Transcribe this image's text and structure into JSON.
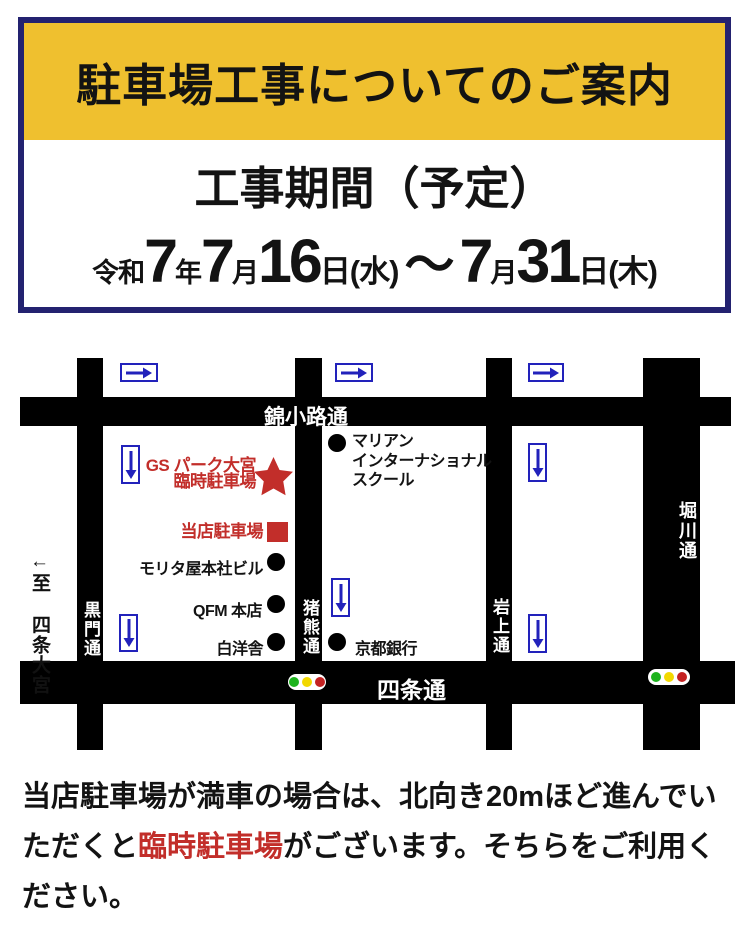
{
  "header": {
    "title": "駐車場工事についてのご案内",
    "period_label": "工事期間（予定）",
    "date": {
      "era": "令和",
      "year": "7",
      "year_unit": "年",
      "month1": "7",
      "month_unit1": "月",
      "day1": "16",
      "day_suffix1": "日(水)",
      "tilde": "～",
      "month2": "7",
      "month_unit2": "月",
      "day2": "31",
      "day_suffix2": "日(木)"
    }
  },
  "map": {
    "streets": {
      "nishikikoji": "錦小路通",
      "shijo": "四条通",
      "kuromon": "黒門通",
      "inokuma": "猪熊通",
      "iwagami": "岩上通",
      "horikawa": "堀川通",
      "to_shijo_omiya": "←至 四条大宮"
    },
    "landmarks": {
      "temp_parking_line1": "GS パーク大宮",
      "temp_parking_line2": "臨時駐車場",
      "our_parking": "当店駐車場",
      "marian_line1": "マリアン",
      "marian_line2": "インターナショナル",
      "marian_line3": "スクール",
      "morita": "モリタ屋本社ビル",
      "qfm": "QFM 本店",
      "hakuyosha": "白洋舎",
      "kyoto_bank": "京都銀行"
    }
  },
  "notice": {
    "line1": "当店駐車場が満車の場合は、北向き20mほど進んでい",
    "line2_pre": "ただくと",
    "line2_red": "臨時駐車場",
    "line2_post": "がございます。そちらをご利用く",
    "line3": "ださい。"
  },
  "colors": {
    "navy_border": "#232270",
    "header_yellow": "#efc02f",
    "accent_red": "#c22e2a",
    "arrow_blue": "#2222bb",
    "signal_green": "#1db31d",
    "signal_yellow": "#f2d800",
    "signal_red": "#c42222"
  }
}
